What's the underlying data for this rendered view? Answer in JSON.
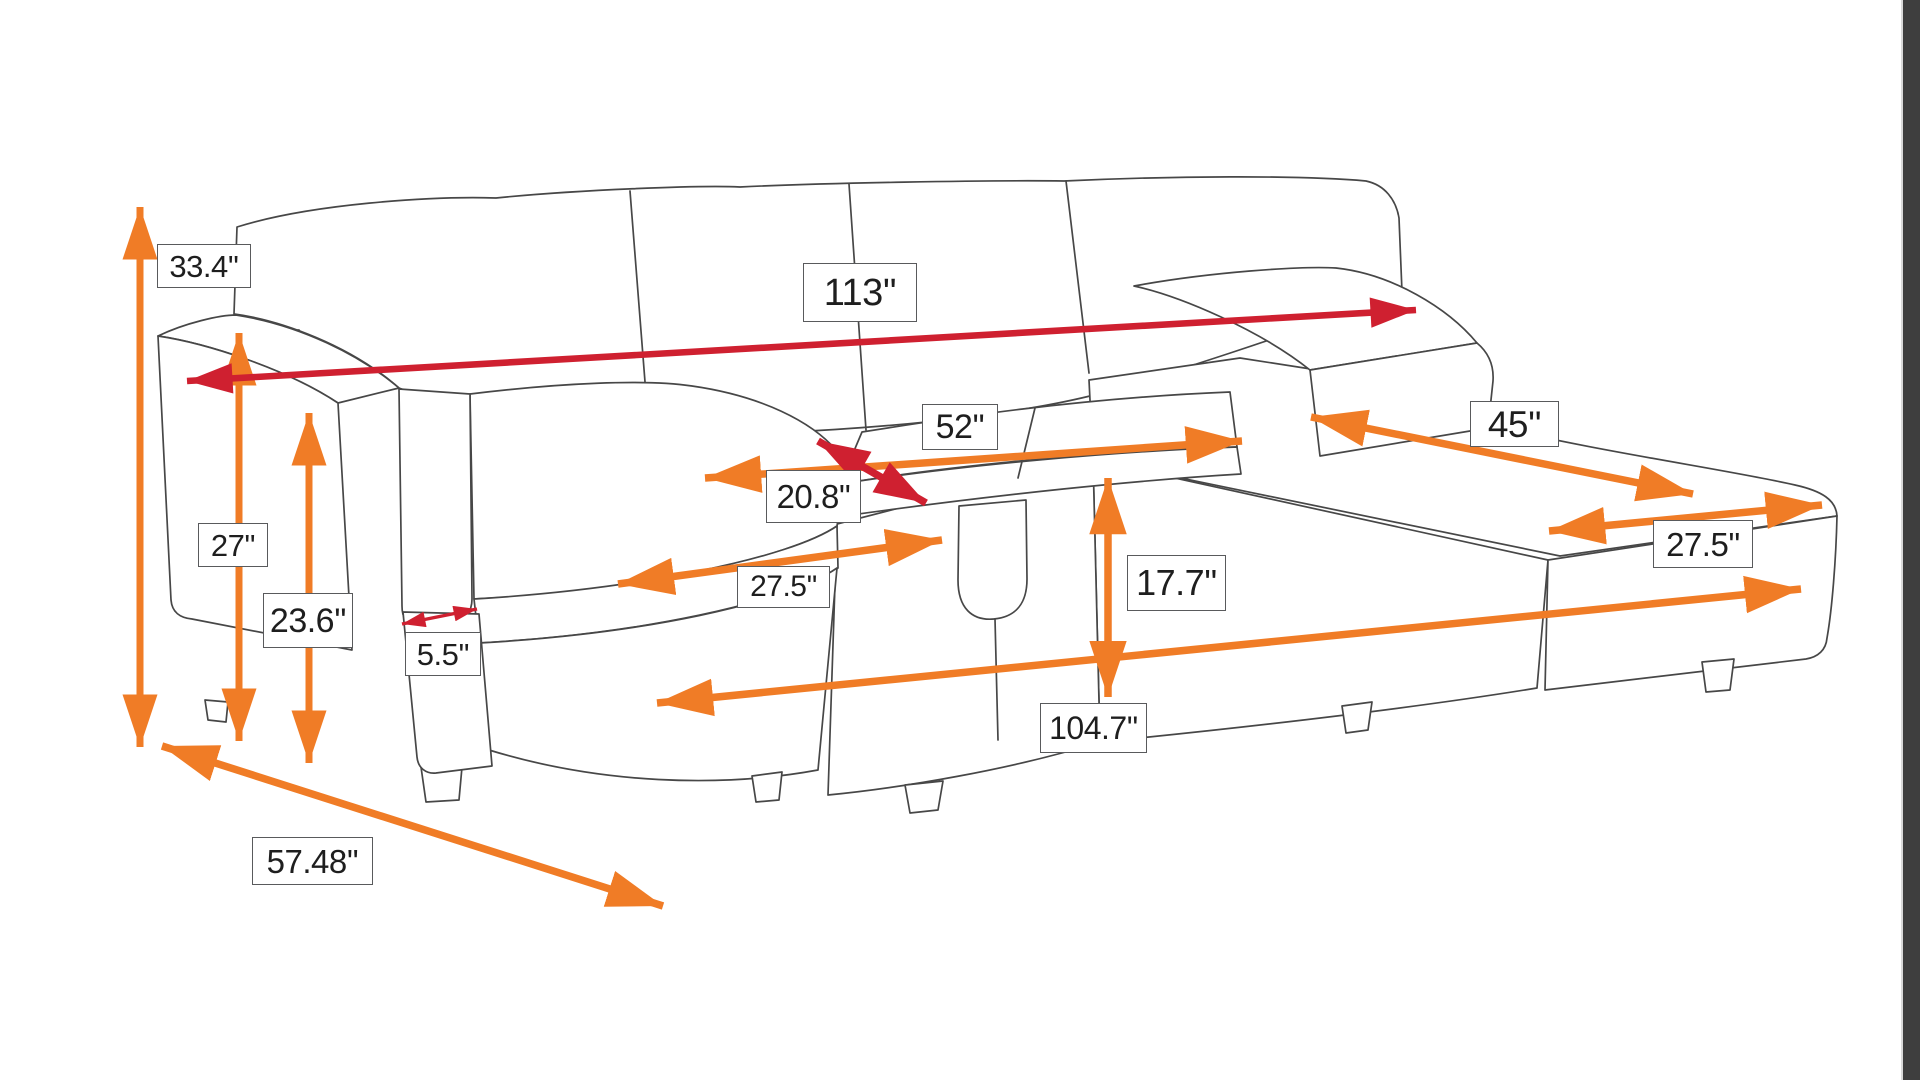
{
  "colors": {
    "background": "#ffffff",
    "arrow_orange": "#f07c26",
    "arrow_red": "#cf2030",
    "line_art": "#474747",
    "label_border": "#595a5c",
    "label_text": "#1e1e1e",
    "edge_strip": "#3e3e3e"
  },
  "dimension_labels": {
    "overall_height": "33.4''",
    "overall_width": "113''",
    "seat_width": "52''",
    "seat_depth": "20.8''",
    "arm_front_height": "27''",
    "arm_back_height": "23.6''",
    "armrest_width": "5.5''",
    "left_chaise_width": "27.5''",
    "seat_height": "17.7''",
    "inner_length": "104.7''",
    "chaise_length": "45''",
    "right_chaise_width": "27.5''",
    "overall_depth": "57.48''"
  }
}
